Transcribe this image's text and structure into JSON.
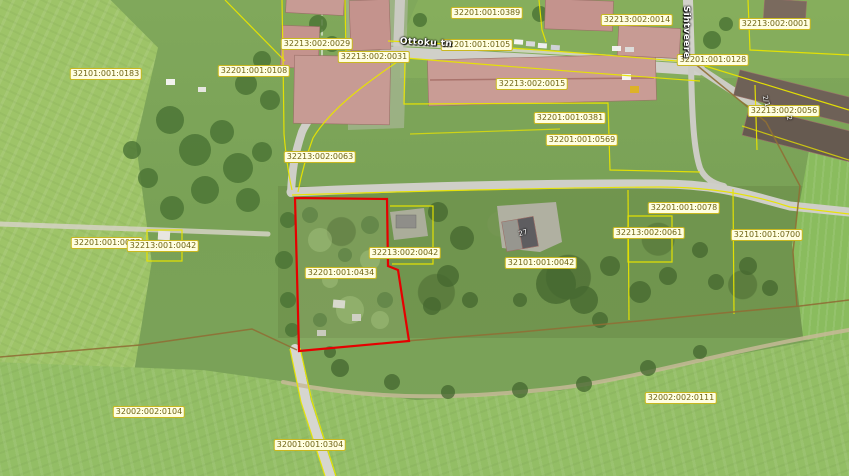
{
  "map": {
    "selected_parcel": "32201:001:0434",
    "colors": {
      "parcel_line": "#e8e400",
      "selected_outline": "#e60000",
      "boundary_brown": "#8f6f35",
      "label_bg": "#fffee0",
      "label_border": "#c9b81f",
      "label_text": "#6f6414",
      "street_text": "#ffffff"
    },
    "street_labels": [
      {
        "text": "Ottoku tn",
        "x": 426,
        "y": 43,
        "rotation": 3
      },
      {
        "text": "Sihtveere",
        "x": 686,
        "y": 32,
        "rotation": 90
      }
    ],
    "building_labels": [
      {
        "text": "2/1",
        "x": 766,
        "y": 101,
        "rotation": 75
      },
      {
        "text": "2",
        "x": 789,
        "y": 118,
        "rotation": 80
      },
      {
        "text": "27",
        "x": 523,
        "y": 233,
        "rotation": -15
      }
    ],
    "parcel_labels": [
      {
        "text": "32201:001:0389",
        "x": 487,
        "y": 13
      },
      {
        "text": "32213:002:0014",
        "x": 637,
        "y": 20
      },
      {
        "text": "32213:002:0001",
        "x": 775,
        "y": 24
      },
      {
        "text": "32213:002:0029",
        "x": 317,
        "y": 44
      },
      {
        "text": "32213:002:0031",
        "x": 374,
        "y": 57
      },
      {
        "text": "32201:001:0105",
        "x": 477,
        "y": 45
      },
      {
        "text": "32201:001:0128",
        "x": 713,
        "y": 60
      },
      {
        "text": "32101:001:0183",
        "x": 106,
        "y": 74
      },
      {
        "text": "32201:001:0108",
        "x": 254,
        "y": 71
      },
      {
        "text": "32213:002:0015",
        "x": 532,
        "y": 84
      },
      {
        "text": "32213:002:0056",
        "x": 784,
        "y": 111
      },
      {
        "text": "32201:001:0381",
        "x": 570,
        "y": 118
      },
      {
        "text": "32201:001:0569",
        "x": 582,
        "y": 140
      },
      {
        "text": "32213:002:0063",
        "x": 320,
        "y": 157
      },
      {
        "text": "32201:001:0078",
        "x": 684,
        "y": 208
      },
      {
        "text": "32201:001:0077",
        "x": 107,
        "y": 243
      },
      {
        "text": "32213:001:0042",
        "x": 163,
        "y": 246
      },
      {
        "text": "32213:002:0061",
        "x": 649,
        "y": 233
      },
      {
        "text": "32101:001:0700",
        "x": 767,
        "y": 235
      },
      {
        "text": "32213:002:0042",
        "x": 405,
        "y": 253
      },
      {
        "text": "32201:001:0434",
        "x": 341,
        "y": 273
      },
      {
        "text": "32101:001:0042",
        "x": 541,
        "y": 263
      },
      {
        "text": "32002:002:0104",
        "x": 149,
        "y": 412
      },
      {
        "text": "32002:002:0111",
        "x": 681,
        "y": 398
      },
      {
        "text": "32001:001:0304",
        "x": 310,
        "y": 445
      }
    ]
  }
}
